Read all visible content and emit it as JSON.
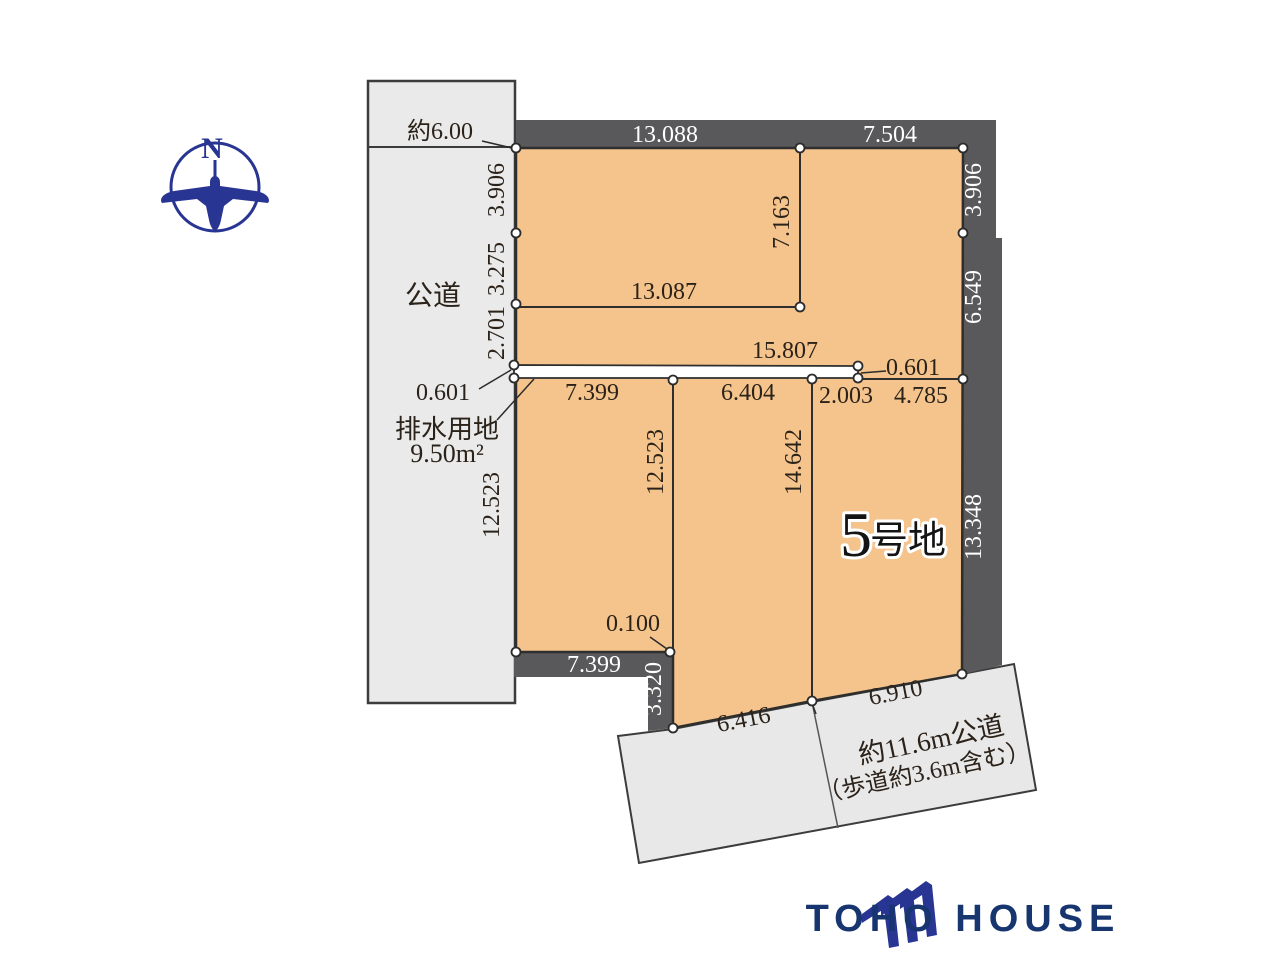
{
  "compass": {
    "north_label": "N"
  },
  "left_road": {
    "name": "公道",
    "width": "約6.00"
  },
  "top_band": {
    "seg1": "13.088",
    "seg2": "7.504"
  },
  "right_band": {
    "seg1": "3.906",
    "seg2": "6.549",
    "seg3": "13.348"
  },
  "bottom_band": {
    "seg1": "7.399",
    "seg2": "3.320"
  },
  "upper_lot": {
    "left_seg1": "3.906",
    "left_seg2": "3.275",
    "left_seg3": "2.701",
    "inner_width": "13.087",
    "inner_height": "7.163"
  },
  "drainage_strip": {
    "name": "排水用地",
    "area": "9.50m²",
    "offset_left": "0.601",
    "offset_right": "0.601",
    "length": "15.807"
  },
  "lower_lots": {
    "lot_a_width": "7.399",
    "lot_a_height": "12.523",
    "lot_a_inner_height": "12.523",
    "lot_b_width": "6.404",
    "lot_b_height": "14.642",
    "lot5_seg1": "2.003",
    "lot5_seg2": "4.785",
    "lot5_number": "5",
    "lot5_name": "号地",
    "corner_offset": "0.100"
  },
  "bottom_road": {
    "edge_seg1": "6.416",
    "edge_seg2": "6.910",
    "name_line1": "約11.6m公道",
    "name_line2": "（歩道約3.6m含む）"
  },
  "logo": {
    "company": "TOHO HOUSE"
  }
}
